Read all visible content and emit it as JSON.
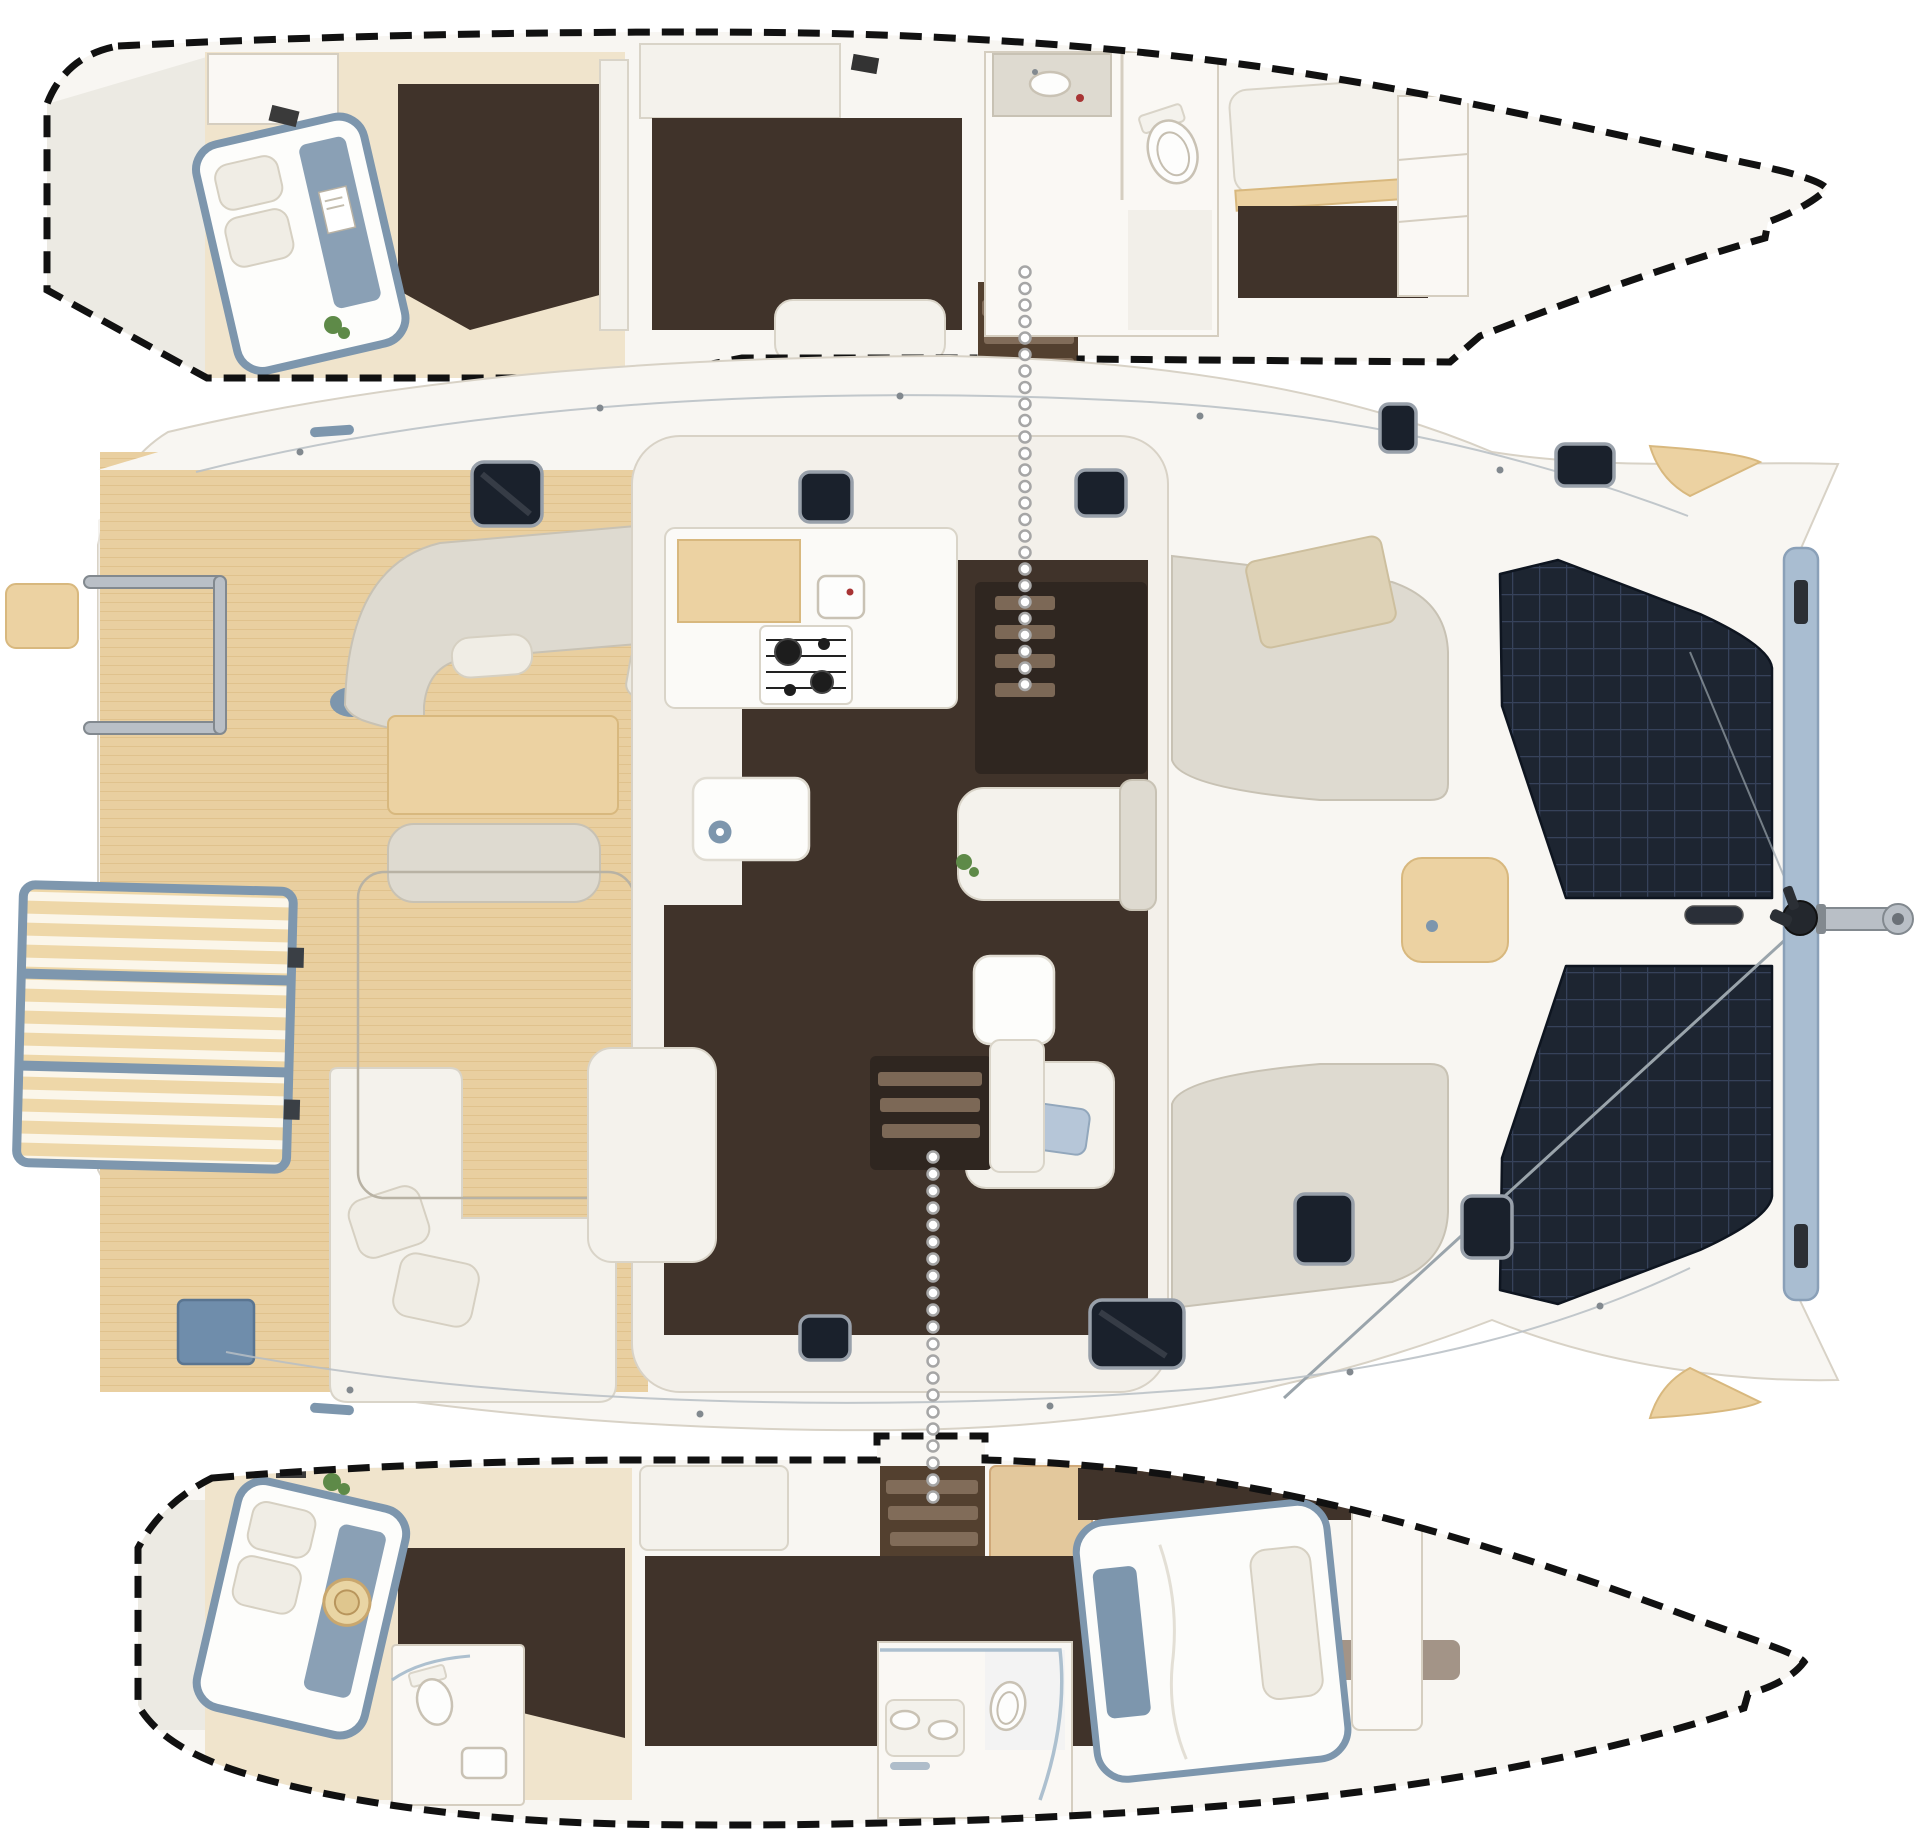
{
  "palette": {
    "background": "#ffffff",
    "hull": "#f8f6f2",
    "hullShade": "#eceae3",
    "deckLine": "#d8d2c6",
    "room": "#faf8f4",
    "wallStroke": "#d5cec0",
    "teak": "#e9cfa0",
    "teakLine": "#d8b87e",
    "slat": "#eed7a8",
    "slatFrame": "#7e97ae",
    "tramp": "#1d2531",
    "trampLine": "#36425a",
    "floorDark": "#40332a",
    "floorDark2": "#2f2620",
    "step": "#8a7460",
    "furn": "#f4f2ec",
    "furnEdge": "#d9d4c8",
    "greige": "#dedad0",
    "wood": "#ecd2a2",
    "woodEdge": "#d8b87e",
    "cushionDeep": "#7d96ad",
    "pillow": "#f0ede5",
    "hatch": "#1a212c",
    "hatchFrame": "#98a0aa",
    "metal": "#b9bfc6",
    "metalDark": "#82898f",
    "outline": "#111111",
    "dotFill": "#ffffff",
    "dotRing": "#a6a6a6",
    "accentRed": "#a83434",
    "plant": "#5e8a48",
    "glass": "#9fb6c8"
  },
  "vessel": {
    "type": "catamaran-floor-plan-top-view",
    "sections": [
      {
        "id": "port-hull-interior",
        "rooms": [
          "aft-cabin-double-bed",
          "vanity-desk",
          "companionway-steps",
          "bathroom-head",
          "forward-cabin-berth"
        ]
      },
      {
        "id": "main-deck",
        "rooms": [
          "swim-platform",
          "boarding-ladder",
          "aft-cockpit-teak",
          "cockpit-dining-settee",
          "cockpit-table",
          "cockpit-lounge",
          "salon-galley",
          "galley-stove",
          "island-table",
          "salon-settee",
          "companionway-up",
          "companionway-down",
          "foredeck-lounge",
          "foredeck-table",
          "trampoline-port",
          "trampoline-starboard",
          "bow-crossbeam",
          "bowsprit-anchor"
        ]
      },
      {
        "id": "starboard-hull-interior",
        "rooms": [
          "aft-cabin-double-bed",
          "aft-bathroom",
          "companionway-steps",
          "forward-bathroom-shower",
          "forward-cabin-double-bed"
        ]
      }
    ]
  },
  "connectors": [
    {
      "name": "port-companionway-link",
      "x": 1025,
      "y1": 272,
      "y2": 700,
      "step": 16.5,
      "r": 5.5
    },
    {
      "name": "starboard-companionway-link",
      "x": 933,
      "y1": 1157,
      "y2": 1505,
      "step": 17,
      "r": 5.5
    }
  ]
}
